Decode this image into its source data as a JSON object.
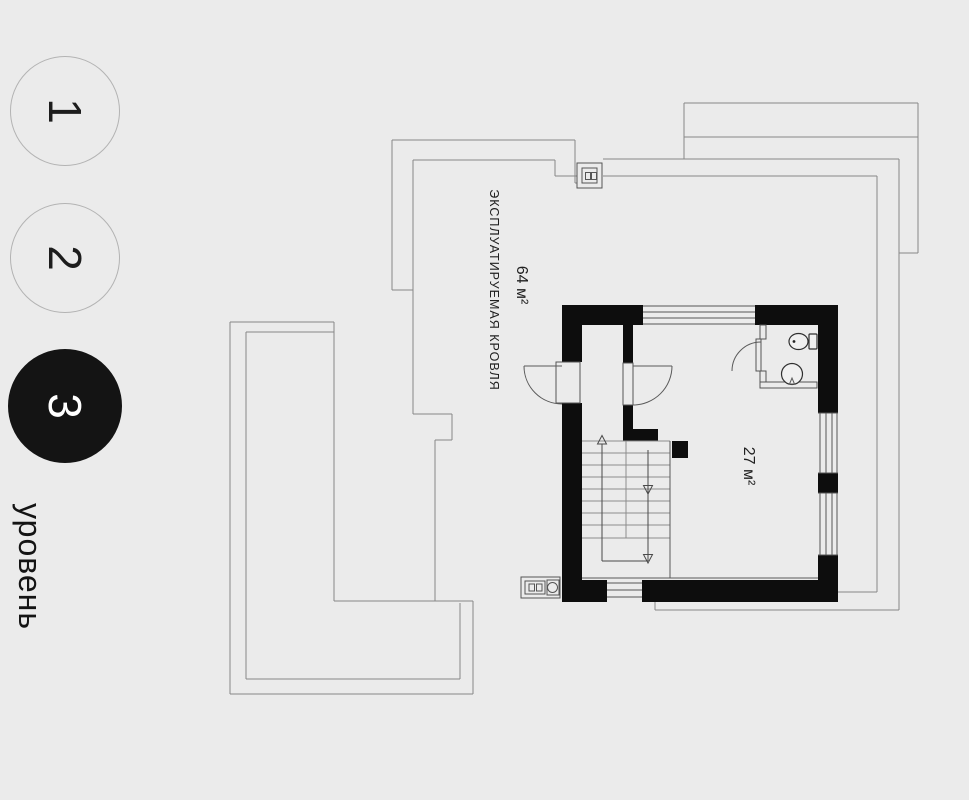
{
  "levels": {
    "caption": "уровень",
    "items": [
      {
        "label": "1",
        "active": false
      },
      {
        "label": "2",
        "active": false
      },
      {
        "label": "3",
        "active": true
      }
    ]
  },
  "plan": {
    "roof_label": "ЭКСПЛУАТИРУЕМАЯ КРОВЛЯ",
    "roof_area": "64 м²",
    "room_area": "27 м²"
  },
  "colors": {
    "background": "#ebebeb",
    "active_level": "#141414",
    "walls": "#0d0d0d",
    "outline": "#878787"
  }
}
